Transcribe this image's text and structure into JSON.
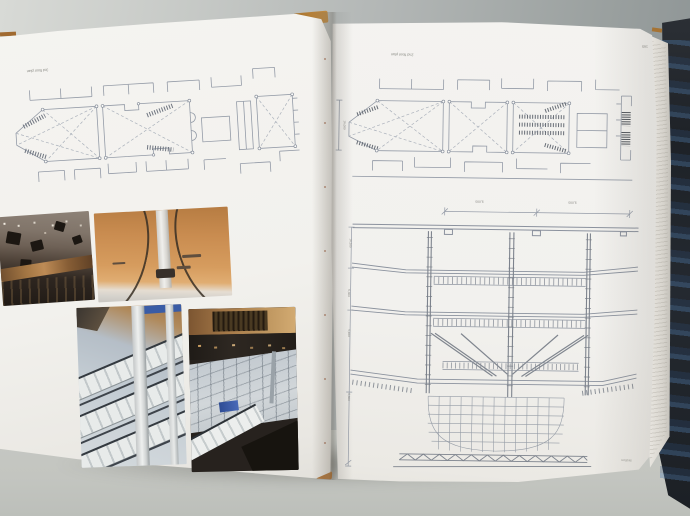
{
  "book": {
    "left_page": {
      "plan_label": "3rd floor plan",
      "photos": [
        {
          "id": "atrium-ceiling-interior-photo"
        },
        {
          "id": "orange-ceiling-arched-ribs-photo"
        },
        {
          "id": "balcony-column-interior-photo"
        },
        {
          "id": "atrium-levels-overview-photo"
        }
      ]
    },
    "right_page": {
      "page_number": "165",
      "plan_label": "2nd floor plan",
      "plan_dim_left": "16,000",
      "section": {
        "label": "section",
        "dims_top": [
          "9,000",
          "9,000"
        ],
        "dims_left": [
          "16,300",
          "6,300",
          "5,400",
          "8,300"
        ]
      }
    }
  },
  "colors": {
    "table_grey": "#b2b6b5",
    "page_white": "#f3f2ee",
    "cover_dark": "#23262b",
    "cover_blue_accent": "#4a6ea0",
    "cover_tan": "#b07437",
    "drawing_line": "#949ba7",
    "photo_orange_ceiling": "#cf9256",
    "photo_blue_sign": "#3558a8"
  }
}
